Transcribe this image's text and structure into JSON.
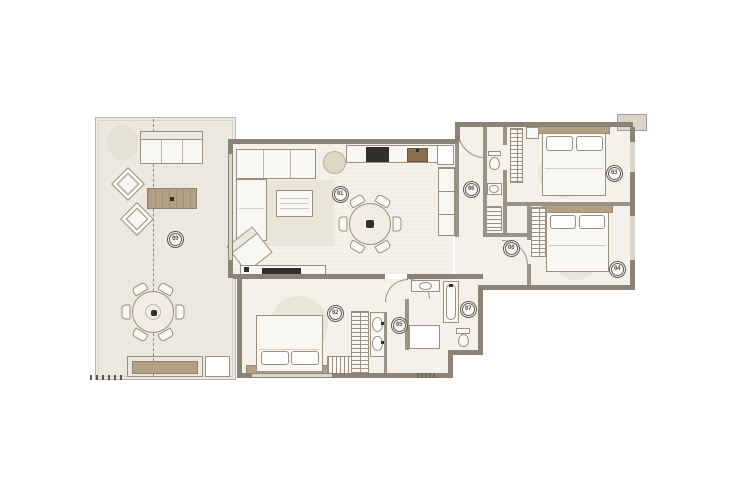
{
  "palette": {
    "wall": "#8c8275",
    "partition": "#9b9286",
    "line": "#99907f",
    "floor": "#f3f1ea",
    "terrace": "#ebe8df",
    "furniture": "#f9f7f2",
    "wood": "#b1a084",
    "wood_dark": "#8a6e50",
    "appliance": "#32302c",
    "rug": "#e9e5d9",
    "window": "#d9d5cb",
    "ink": "#5f584e",
    "background": "#ffffff"
  },
  "markers": [
    {
      "label": "01"
    },
    {
      "label": "02"
    },
    {
      "label": "03"
    },
    {
      "label": "04"
    },
    {
      "label": "05"
    },
    {
      "label": "06"
    },
    {
      "label": "07"
    },
    {
      "label": "08"
    },
    {
      "label": "09"
    }
  ]
}
